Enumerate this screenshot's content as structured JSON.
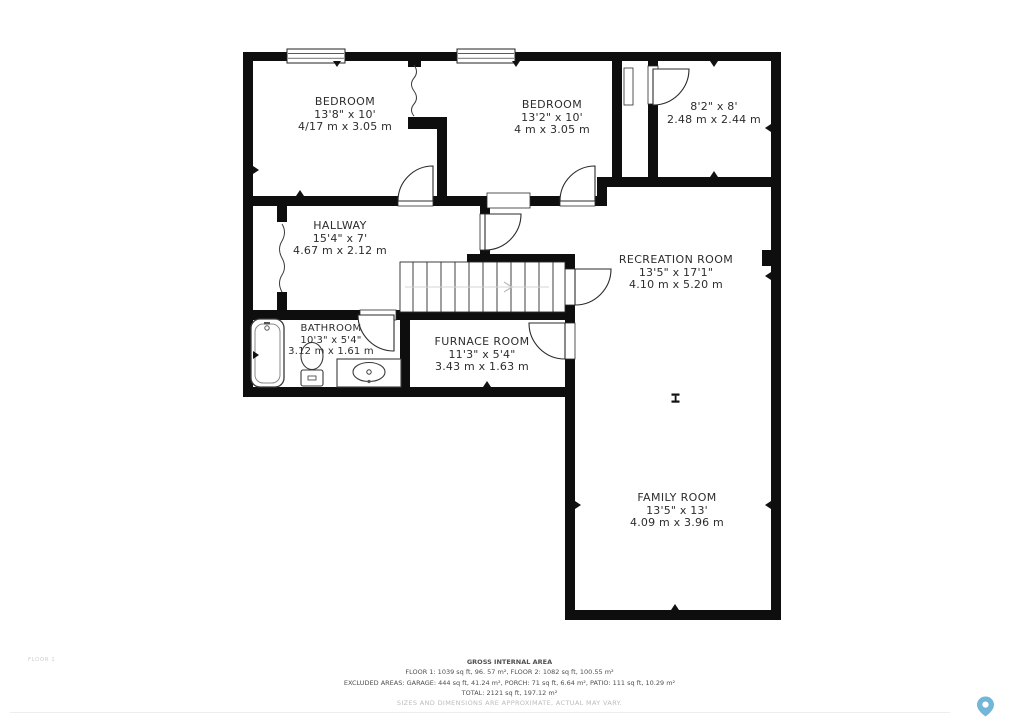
{
  "floor_plan": {
    "floor_label": "FLOOR 1",
    "rooms": [
      {
        "name": "BEDROOM",
        "imperial": "13'8\" x 10'",
        "metric": "4/17 m x 3.05 m"
      },
      {
        "name": "BEDROOM",
        "imperial": "13'2\" x 10'",
        "metric": "4 m x 3.05 m"
      },
      {
        "name": "",
        "imperial": "8'2\" x 8'",
        "metric": "2.48 m x 2.44 m"
      },
      {
        "name": "HALLWAY",
        "imperial": "15'4\" x 7'",
        "metric": "4.67 m x 2.12 m"
      },
      {
        "name": "RECREATION ROOM",
        "imperial": "13'5\" x 17'1\"",
        "metric": "4.10 m x 5.20 m"
      },
      {
        "name": "BATHROOM",
        "imperial": "10'3\" x 5'4\"",
        "metric": "3.12 m x 1.61 m"
      },
      {
        "name": "FURNACE ROOM",
        "imperial": "11'3\" x 5'4\"",
        "metric": "3.43 m x 1.63 m"
      },
      {
        "name": "FAMILY ROOM",
        "imperial": "13'5\" x 13'",
        "metric": "4.09 m x 3.96 m"
      }
    ],
    "footer": {
      "title": "GROSS INTERNAL AREA",
      "line1": "FLOOR 1: 1039 sq ft, 96. 57 m², FLOOR 2: 1082 sq ft, 100.55 m²",
      "line2": "EXCLUDED AREAS: GARAGE: 444 sq ft, 41.24 m², PORCH: 71 sq ft, 6.64 m², PATIO: 111 sq ft, 10.29 m²",
      "line3": "TOTAL: 2121 sq ft, 197.12 m²",
      "disclaimer": "SIZES AND DIMENSIONS ARE APPROXIMATE, ACTUAL MAY VARY."
    },
    "watermark_icon": "map-pin-icon",
    "colors": {
      "wall": "#0e0e0e",
      "pin": "#72b6d8",
      "muted_text": "#bcbcbc"
    }
  }
}
